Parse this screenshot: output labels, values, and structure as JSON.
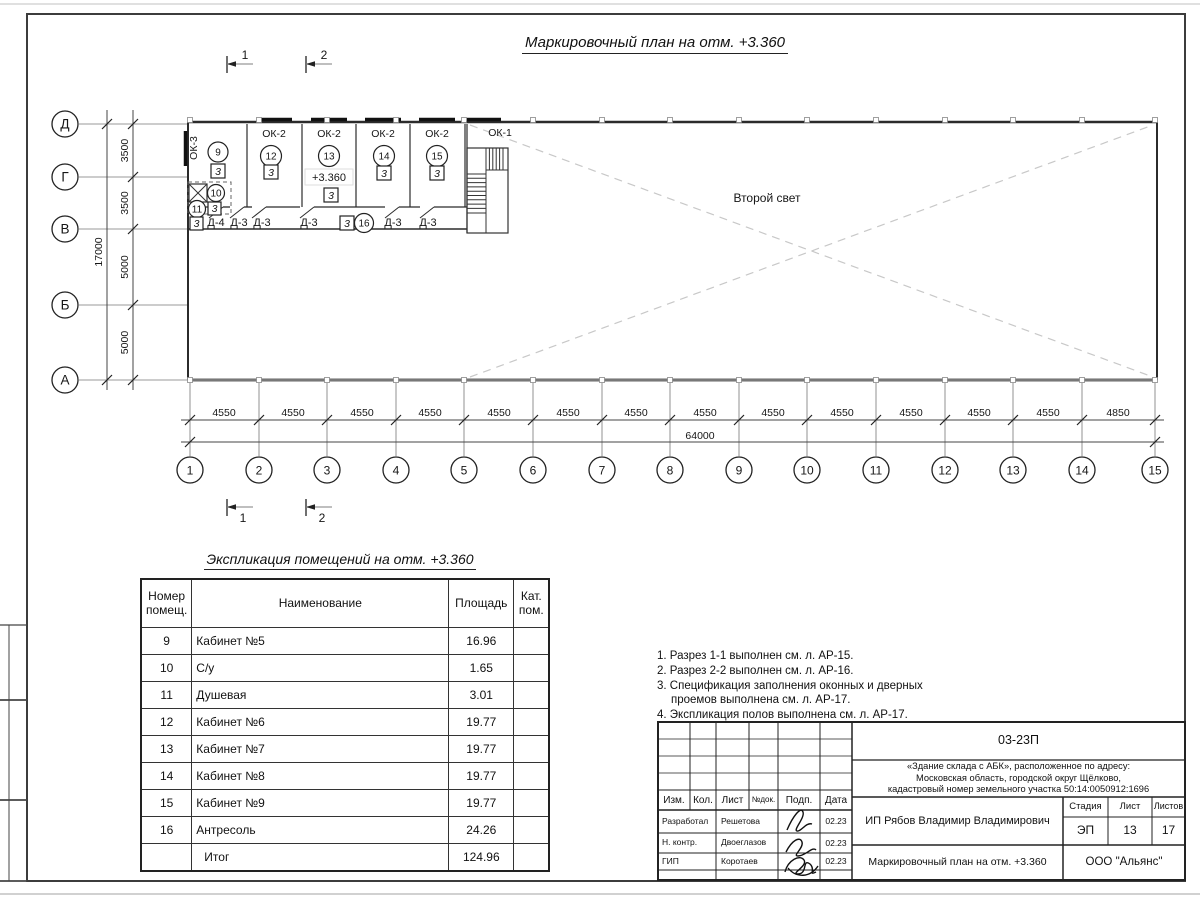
{
  "sheet": {
    "line_color": "#1a1a1a",
    "background": "#ffffff"
  },
  "plan": {
    "title": "Маркировочный план на отм. +3.360",
    "second_light_label": "Второй свет",
    "elevation_mark": "+3.360",
    "axes_rows": [
      "Д",
      "Г",
      "В",
      "Б",
      "А"
    ],
    "row_dims": [
      "3500",
      "3500",
      "5000",
      "5000"
    ],
    "row_total": "17000",
    "col_labels": [
      "1",
      "2",
      "3",
      "4",
      "5",
      "6",
      "7",
      "8",
      "9",
      "10",
      "11",
      "12",
      "13",
      "14",
      "15"
    ],
    "col_dims": [
      "4550",
      "4550",
      "4550",
      "4550",
      "4550",
      "4550",
      "4550",
      "4550",
      "4550",
      "4550",
      "4550",
      "4550",
      "4550",
      "4850"
    ],
    "col_total": "64000",
    "windows": {
      "ok1": "ОК-1",
      "ok2": "ОК-2",
      "ok3": "ОК-3"
    },
    "rooms": {
      "r9": {
        "num": "9",
        "cat": "3"
      },
      "r10": {
        "num": "10",
        "cat": "3"
      },
      "r11": {
        "num": "11",
        "cat": "3"
      },
      "r12": {
        "num": "12",
        "cat": "3"
      },
      "r13": {
        "num": "13",
        "cat": "3"
      },
      "r14": {
        "num": "14",
        "cat": "3"
      },
      "r15": {
        "num": "15",
        "cat": "3"
      },
      "r16": {
        "num": "16",
        "cat": "3"
      }
    },
    "doors": [
      "Д-4",
      "Д-3",
      "Д-3",
      "Д-3",
      "Д-3",
      "Д-3"
    ],
    "section_marks": [
      "1",
      "2"
    ]
  },
  "explication": {
    "title": "Экспликация помещений на отм. +3.360",
    "headers": [
      "Номер помещ.",
      "Наименование",
      "Площадь",
      "Кат. пом."
    ],
    "rows": [
      {
        "num": "9",
        "name": "Кабинет №5",
        "area": "16.96",
        "cat": ""
      },
      {
        "num": "10",
        "name": "С/у",
        "area": "1.65",
        "cat": ""
      },
      {
        "num": "11",
        "name": "Душевая",
        "area": "3.01",
        "cat": ""
      },
      {
        "num": "12",
        "name": "Кабинет №6",
        "area": "19.77",
        "cat": ""
      },
      {
        "num": "13",
        "name": "Кабинет №7",
        "area": "19.77",
        "cat": ""
      },
      {
        "num": "14",
        "name": "Кабинет №8",
        "area": "19.77",
        "cat": ""
      },
      {
        "num": "15",
        "name": "Кабинет №9",
        "area": "19.77",
        "cat": ""
      },
      {
        "num": "16",
        "name": "Антресоль",
        "area": "24.26",
        "cat": ""
      },
      {
        "num": "",
        "name": "Итог",
        "area": "124.96",
        "cat": ""
      }
    ]
  },
  "notes": {
    "lines": [
      "1. Разрез 1-1 выполнен см. л. АР-15.",
      "2. Разрез 2-2 выполнен см. л. АР-16.",
      "3. Спецификация заполнения оконных и дверных",
      "проемов выполнена см. л. АР-17.",
      "4. Экспликация полов выполнена см. л. АР-17."
    ]
  },
  "titleblock": {
    "doc_number": "03-23П",
    "project_lines": [
      "«Здание склада с АБК», расположенное по адресу:",
      "Московская область, городской округ Щёлково,",
      "кадастровый номер земельного участка 50:14:0050912:1696"
    ],
    "cols": [
      "Изм.",
      "Кол.",
      "Лист",
      "№док.",
      "Подп.",
      "Дата"
    ],
    "rows": [
      {
        "role": "Разработал",
        "name": "Решетова",
        "date": "02.23"
      },
      {
        "role": "Н. контр.",
        "name": "Двоеглазов",
        "date": "02.23"
      },
      {
        "role": "ГИП",
        "name": "Коротаев",
        "date": "02.23"
      }
    ],
    "client": "ИП Рябов Владимир Владимирович",
    "stage_label": "Стадия",
    "sheet_label": "Лист",
    "sheets_label": "Листов",
    "stage": "ЭП",
    "sheet_no": "13",
    "sheets_total": "17",
    "drawing_title": "Маркировочный план на отм. +3.360",
    "company": "ООО \"Альянс\""
  }
}
